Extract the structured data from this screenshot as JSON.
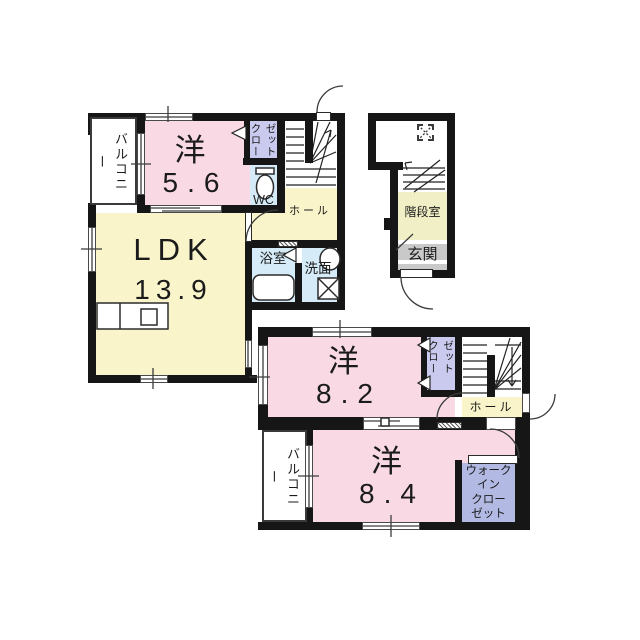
{
  "plan": {
    "type": "floorplan",
    "colors": {
      "wall": "#161616",
      "room_pink": "#f9dae4",
      "room_yellow": "#f9f4c9",
      "closet_lavender": "#cacaee",
      "water_blue": "#d5ebf7",
      "wic_blue": "#b2b9e2",
      "entrance_gray": "#c9c9c9",
      "background": "#ffffff"
    },
    "left_unit": {
      "balcony_label": "バルコニー",
      "room1_kanji": "洋",
      "room1_size": "5.6",
      "closet_col1": "クロー",
      "closet_col2": "ゼット",
      "wc_label": "WC",
      "hall_label": "ホール",
      "ldk_kanji": "LDK",
      "ldk_size": "13.9",
      "bath_label": "浴室",
      "wash_label": "洗面"
    },
    "entry_unit": {
      "stair_room_label": "階段室",
      "entrance_label": "玄関"
    },
    "bottom_unit": {
      "room2_kanji": "洋",
      "room2_size": "8.2",
      "closet_col1": "クロー",
      "closet_col2": "ゼット",
      "hall_label": "ホール",
      "room3_kanji": "洋",
      "room3_size": "8.4",
      "balcony_label": "バルコニー",
      "wic_lines": [
        "ウォーク",
        "イン",
        "クロー",
        "ゼット"
      ]
    }
  }
}
